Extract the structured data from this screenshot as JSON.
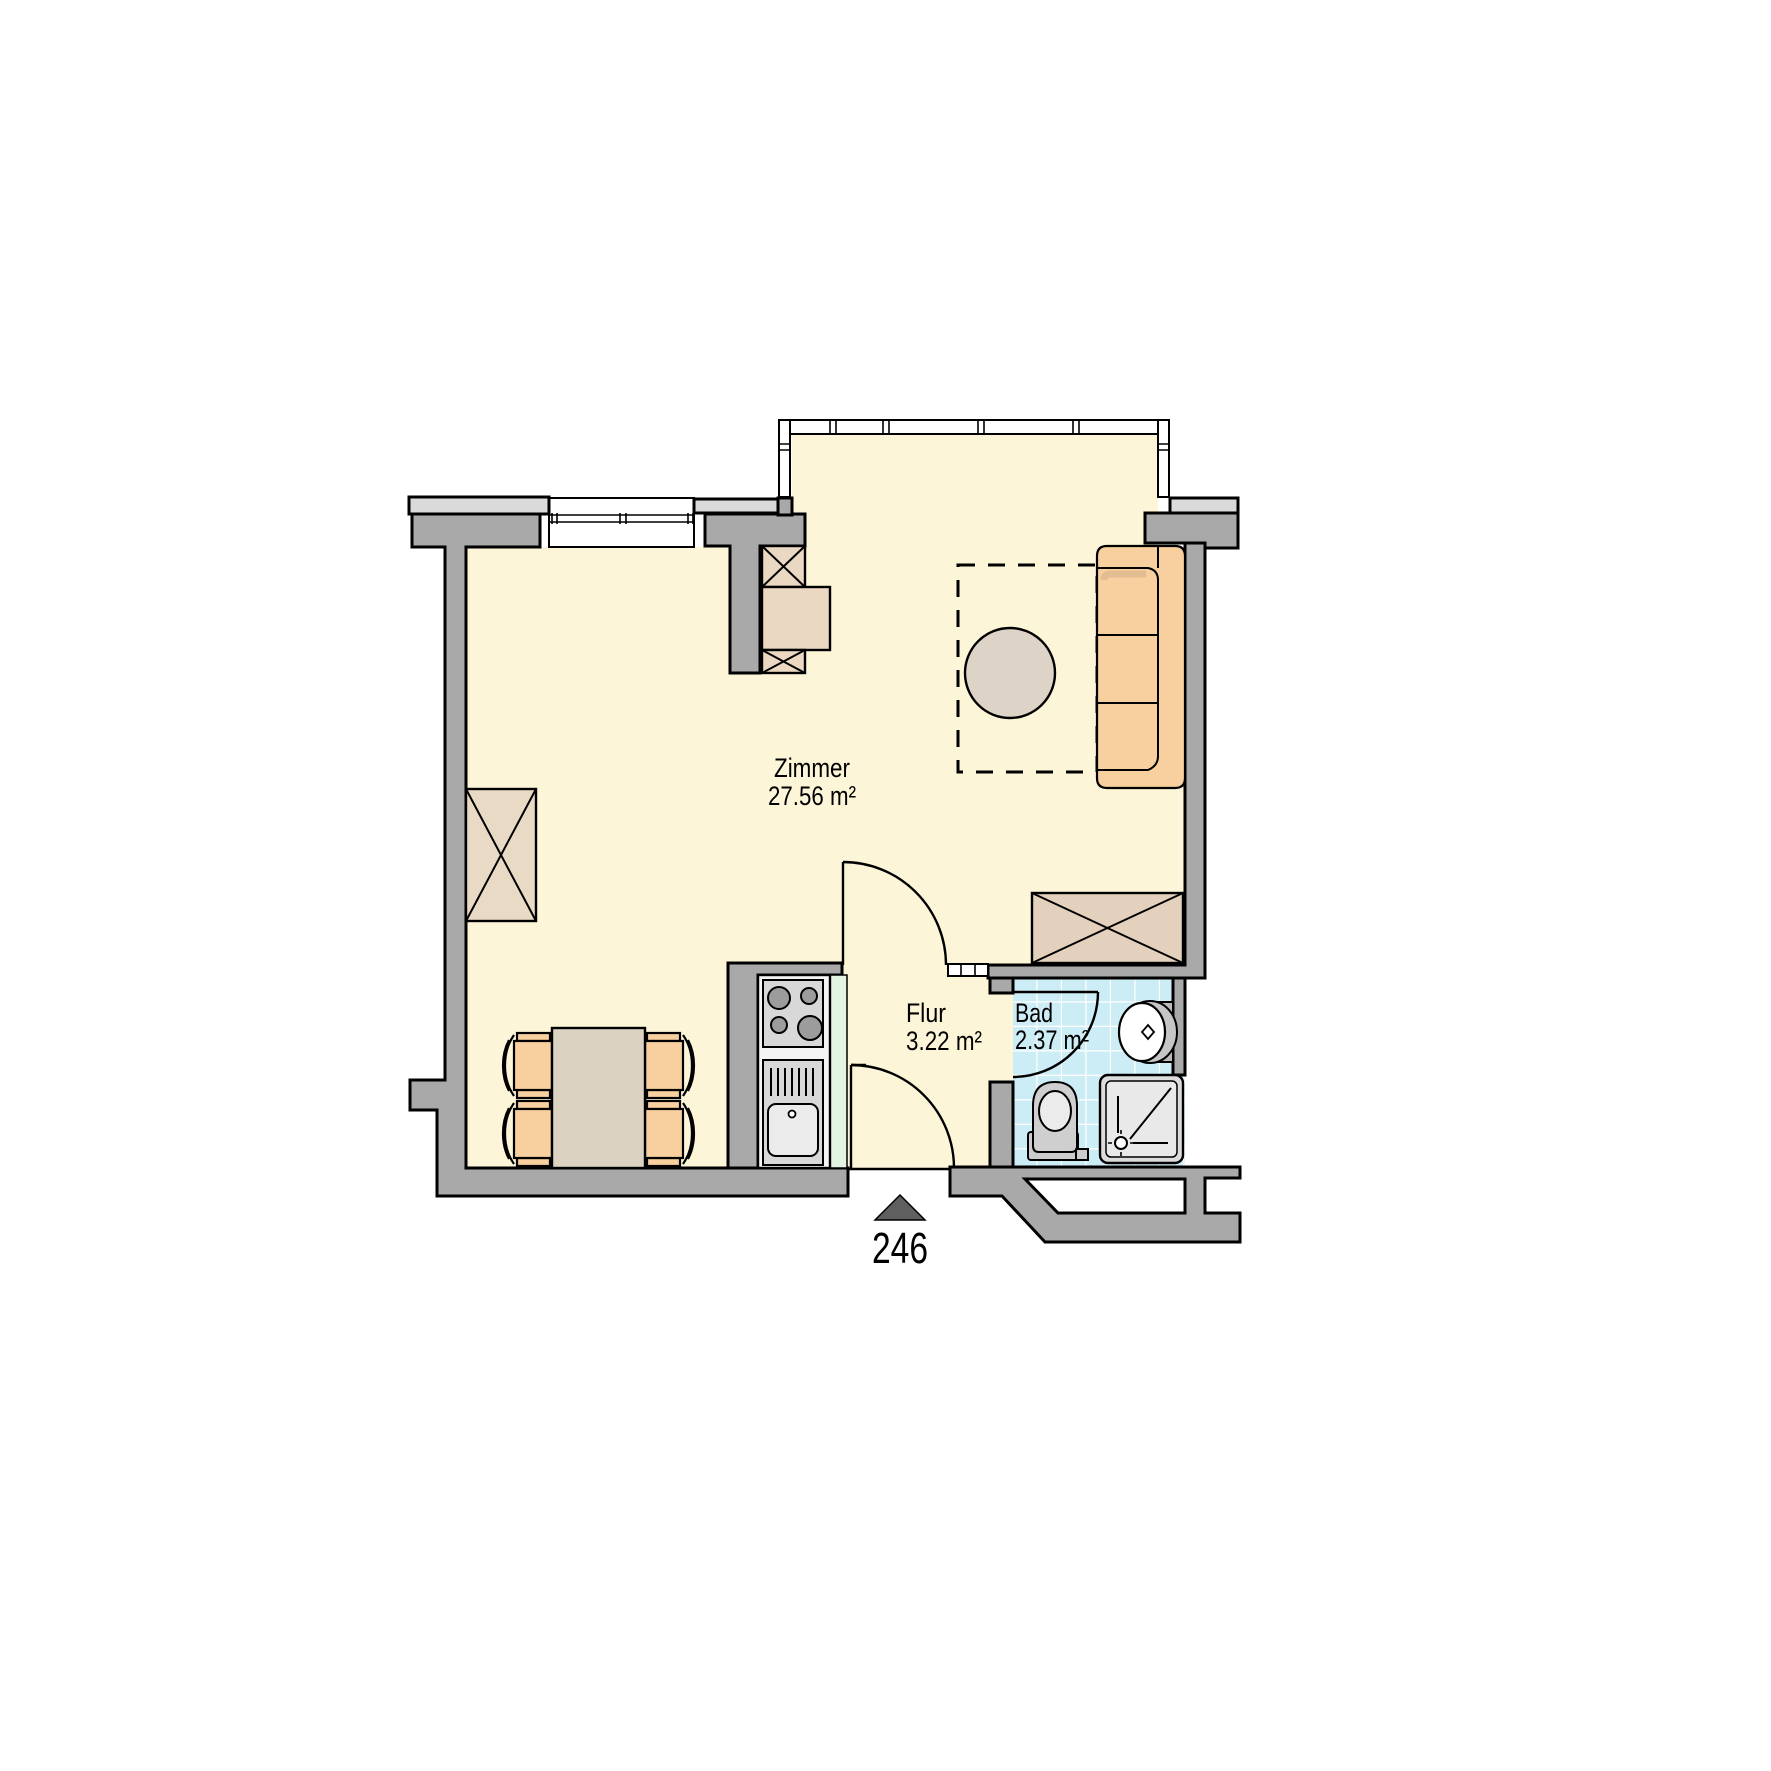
{
  "plan": {
    "unit_number": "246",
    "rooms": [
      {
        "name": "Zimmer",
        "area": "27.56 m²"
      },
      {
        "name": "Flur",
        "area": "3.22 m²"
      },
      {
        "name": "Bad",
        "area": "2.37 m²"
      }
    ],
    "fixtures": [
      "sofa",
      "round-table",
      "dining-table",
      "chairs",
      "wardrobes",
      "stove",
      "kitchen-sink",
      "bath-sink",
      "toilet",
      "shower",
      "entrance-arrow"
    ]
  },
  "colors": {
    "wall": "#a9a9a9",
    "wall_cap": "#dadada",
    "floor": "#fcf5d8",
    "tile": "#cdedf6",
    "tile_grid": "#ffffff",
    "furniture_tan": "#e9dac6",
    "upholstery": "#f8cf9e",
    "table": "#dcd2c2",
    "counter_green": "#e3f4e2",
    "fixture": "#d8d8d8",
    "entrance_arrow": "#5f5f5f",
    "outline": "#000000"
  }
}
